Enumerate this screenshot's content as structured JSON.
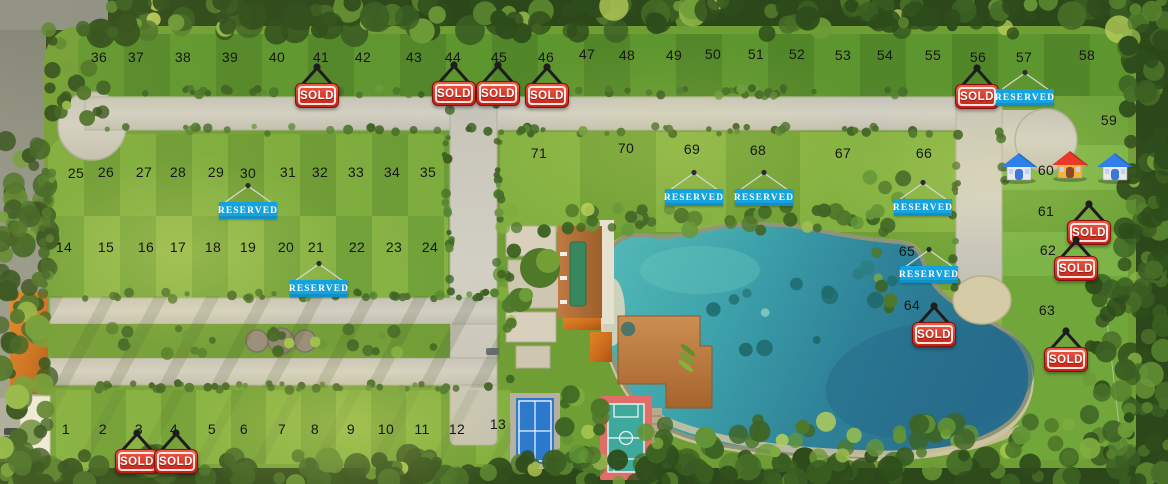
{
  "plan": {
    "name": "residential-lots-master-plan",
    "labels": {
      "sold": "SOLD",
      "reserved": "RESERVED"
    },
    "colors": {
      "sold_sign_red": "#d0261a",
      "reserved_sign_cyan": "#15a3df",
      "lake_teal": "#3da2ab",
      "grass_green": "#74a136",
      "road_gravel": "#cbc8be"
    },
    "features": [
      "lake",
      "clubhouse",
      "swimming-pool",
      "wooden-deck",
      "kayaks",
      "tennis-court",
      "basketball-court",
      "cul-de-sac",
      "tree-border"
    ],
    "lots": [
      {
        "n": "1",
        "x": 66,
        "y": 429,
        "status": "available"
      },
      {
        "n": "2",
        "x": 103,
        "y": 429,
        "status": "available"
      },
      {
        "n": "3",
        "x": 139,
        "y": 429,
        "status": "sold"
      },
      {
        "n": "4",
        "x": 174,
        "y": 429,
        "status": "sold"
      },
      {
        "n": "5",
        "x": 212,
        "y": 429,
        "status": "available"
      },
      {
        "n": "6",
        "x": 244,
        "y": 429,
        "status": "available"
      },
      {
        "n": "7",
        "x": 282,
        "y": 429,
        "status": "available"
      },
      {
        "n": "8",
        "x": 315,
        "y": 429,
        "status": "available"
      },
      {
        "n": "9",
        "x": 351,
        "y": 429,
        "status": "available"
      },
      {
        "n": "10",
        "x": 386,
        "y": 429,
        "status": "available"
      },
      {
        "n": "11",
        "x": 422,
        "y": 429,
        "status": "available"
      },
      {
        "n": "12",
        "x": 457,
        "y": 429,
        "status": "available"
      },
      {
        "n": "13",
        "x": 498,
        "y": 424,
        "status": "available"
      },
      {
        "n": "14",
        "x": 64,
        "y": 247,
        "status": "available"
      },
      {
        "n": "15",
        "x": 106,
        "y": 247,
        "status": "available"
      },
      {
        "n": "16",
        "x": 146,
        "y": 247,
        "status": "available"
      },
      {
        "n": "17",
        "x": 178,
        "y": 247,
        "status": "available"
      },
      {
        "n": "18",
        "x": 213,
        "y": 247,
        "status": "available"
      },
      {
        "n": "19",
        "x": 248,
        "y": 247,
        "status": "available"
      },
      {
        "n": "20",
        "x": 286,
        "y": 247,
        "status": "available"
      },
      {
        "n": "21",
        "x": 316,
        "y": 247,
        "status": "reserved"
      },
      {
        "n": "22",
        "x": 357,
        "y": 247,
        "status": "available"
      },
      {
        "n": "23",
        "x": 394,
        "y": 247,
        "status": "available"
      },
      {
        "n": "24",
        "x": 430,
        "y": 247,
        "status": "available"
      },
      {
        "n": "25",
        "x": 76,
        "y": 173,
        "status": "available"
      },
      {
        "n": "26",
        "x": 106,
        "y": 172,
        "status": "available"
      },
      {
        "n": "27",
        "x": 144,
        "y": 172,
        "status": "available"
      },
      {
        "n": "28",
        "x": 178,
        "y": 172,
        "status": "available"
      },
      {
        "n": "29",
        "x": 216,
        "y": 172,
        "status": "available"
      },
      {
        "n": "30",
        "x": 248,
        "y": 173,
        "status": "reserved"
      },
      {
        "n": "31",
        "x": 288,
        "y": 172,
        "status": "available"
      },
      {
        "n": "32",
        "x": 320,
        "y": 172,
        "status": "available"
      },
      {
        "n": "33",
        "x": 356,
        "y": 172,
        "status": "available"
      },
      {
        "n": "34",
        "x": 392,
        "y": 172,
        "status": "available"
      },
      {
        "n": "35",
        "x": 428,
        "y": 172,
        "status": "available"
      },
      {
        "n": "36",
        "x": 99,
        "y": 57,
        "status": "available"
      },
      {
        "n": "37",
        "x": 136,
        "y": 57,
        "status": "available"
      },
      {
        "n": "38",
        "x": 183,
        "y": 57,
        "status": "available"
      },
      {
        "n": "39",
        "x": 230,
        "y": 57,
        "status": "available"
      },
      {
        "n": "40",
        "x": 277,
        "y": 57,
        "status": "available"
      },
      {
        "n": "41",
        "x": 321,
        "y": 57,
        "status": "sold"
      },
      {
        "n": "42",
        "x": 363,
        "y": 57,
        "status": "available"
      },
      {
        "n": "43",
        "x": 414,
        "y": 57,
        "status": "available"
      },
      {
        "n": "44",
        "x": 453,
        "y": 57,
        "status": "sold"
      },
      {
        "n": "45",
        "x": 499,
        "y": 57,
        "status": "sold"
      },
      {
        "n": "46",
        "x": 546,
        "y": 57,
        "status": "sold"
      },
      {
        "n": "47",
        "x": 587,
        "y": 54,
        "status": "available"
      },
      {
        "n": "48",
        "x": 627,
        "y": 55,
        "status": "available"
      },
      {
        "n": "49",
        "x": 674,
        "y": 55,
        "status": "available"
      },
      {
        "n": "50",
        "x": 713,
        "y": 54,
        "status": "available"
      },
      {
        "n": "51",
        "x": 756,
        "y": 54,
        "status": "available"
      },
      {
        "n": "52",
        "x": 797,
        "y": 54,
        "status": "available"
      },
      {
        "n": "53",
        "x": 843,
        "y": 55,
        "status": "available"
      },
      {
        "n": "54",
        "x": 885,
        "y": 55,
        "status": "available"
      },
      {
        "n": "55",
        "x": 933,
        "y": 55,
        "status": "available"
      },
      {
        "n": "56",
        "x": 978,
        "y": 57,
        "status": "sold"
      },
      {
        "n": "57",
        "x": 1024,
        "y": 57,
        "status": "reserved"
      },
      {
        "n": "58",
        "x": 1087,
        "y": 55,
        "status": "available"
      },
      {
        "n": "59",
        "x": 1109,
        "y": 120,
        "status": "available"
      },
      {
        "n": "60",
        "x": 1046,
        "y": 170,
        "status": "houses"
      },
      {
        "n": "61",
        "x": 1046,
        "y": 211,
        "status": "sold"
      },
      {
        "n": "62",
        "x": 1048,
        "y": 250,
        "status": "sold"
      },
      {
        "n": "63",
        "x": 1047,
        "y": 310,
        "status": "sold"
      },
      {
        "n": "64",
        "x": 912,
        "y": 305,
        "status": "sold"
      },
      {
        "n": "65",
        "x": 907,
        "y": 251,
        "status": "reserved"
      },
      {
        "n": "66",
        "x": 924,
        "y": 153,
        "status": "reserved"
      },
      {
        "n": "67",
        "x": 843,
        "y": 153,
        "status": "available"
      },
      {
        "n": "68",
        "x": 758,
        "y": 150,
        "status": "reserved"
      },
      {
        "n": "69",
        "x": 692,
        "y": 149,
        "status": "reserved"
      },
      {
        "n": "70",
        "x": 626,
        "y": 148,
        "status": "available"
      },
      {
        "n": "71",
        "x": 539,
        "y": 153,
        "status": "available"
      }
    ],
    "signs": [
      {
        "lot": "41",
        "type": "sold",
        "x": 317,
        "y": 95
      },
      {
        "lot": "44",
        "type": "sold",
        "x": 454,
        "y": 93
      },
      {
        "lot": "45",
        "type": "sold",
        "x": 498,
        "y": 93
      },
      {
        "lot": "46",
        "type": "sold",
        "x": 547,
        "y": 95
      },
      {
        "lot": "56",
        "type": "sold",
        "x": 977,
        "y": 96
      },
      {
        "lot": "57",
        "type": "reserved",
        "x": 1025,
        "y": 97
      },
      {
        "lot": "30",
        "type": "reserved",
        "x": 248,
        "y": 210
      },
      {
        "lot": "21",
        "type": "reserved",
        "x": 319,
        "y": 288
      },
      {
        "lot": "69",
        "type": "reserved",
        "x": 694,
        "y": 197
      },
      {
        "lot": "68",
        "type": "reserved",
        "x": 764,
        "y": 197
      },
      {
        "lot": "66",
        "type": "reserved",
        "x": 923,
        "y": 207
      },
      {
        "lot": "65",
        "type": "reserved",
        "x": 929,
        "y": 274
      },
      {
        "lot": "64",
        "type": "sold",
        "x": 934,
        "y": 334
      },
      {
        "lot": "61",
        "type": "sold",
        "x": 1089,
        "y": 232
      },
      {
        "lot": "62",
        "type": "sold",
        "x": 1076,
        "y": 268
      },
      {
        "lot": "63",
        "type": "sold",
        "x": 1066,
        "y": 359
      },
      {
        "lot": "3",
        "type": "sold",
        "x": 137,
        "y": 461
      },
      {
        "lot": "4",
        "type": "sold",
        "x": 176,
        "y": 461
      }
    ],
    "house_icons": [
      {
        "x": 1019,
        "y": 168,
        "variant": "blue"
      },
      {
        "x": 1070,
        "y": 166,
        "variant": "red"
      },
      {
        "x": 1115,
        "y": 168,
        "variant": "blue"
      }
    ]
  }
}
